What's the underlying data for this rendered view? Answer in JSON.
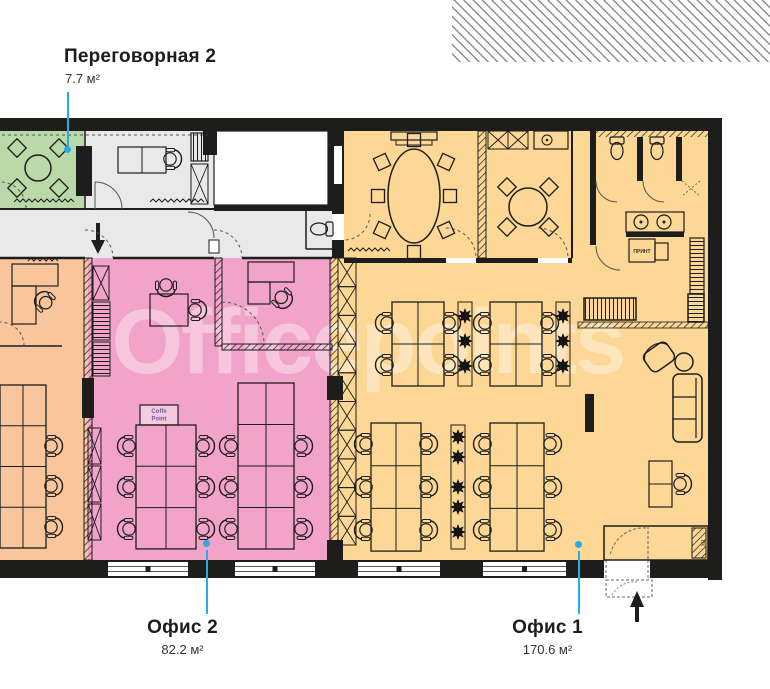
{
  "watermark": "Officepoints",
  "colors": {
    "wall": "#1d1d1b",
    "green": "#b9d9a9",
    "grey": "#e9e9e9",
    "pink": "#f2a3c9",
    "orange": "#f8c59d",
    "yellow": "#fcd795",
    "leader": "#29abe2",
    "hatch_band": "#8f8f8f"
  },
  "labels": {
    "meeting2": {
      "title": "Переговорная 2",
      "area": "7.7 м²"
    },
    "office2": {
      "title": "Офис 2",
      "area": "82.2 м²"
    },
    "office1": {
      "title": "Офис 1",
      "area": "170.6 м²"
    }
  },
  "plan_texts": {
    "coffee_line1": "Coffe",
    "coffee_line2": "Point",
    "printer": "ПРИНТ",
    "entry_box": "ПК"
  }
}
